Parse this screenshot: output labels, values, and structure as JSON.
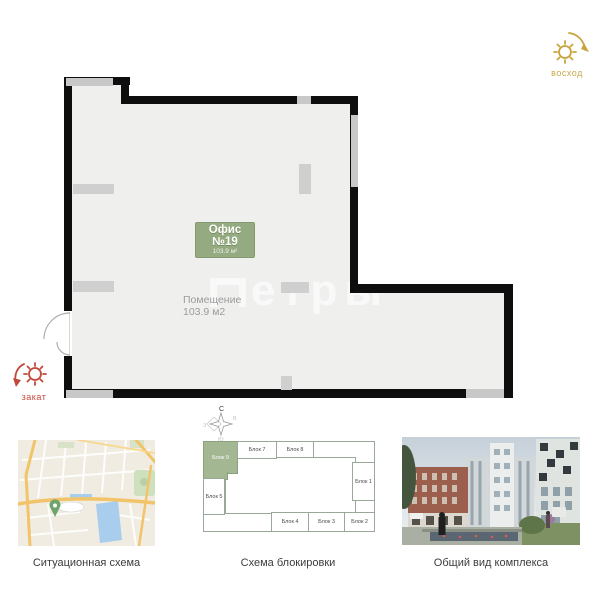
{
  "plan": {
    "badge": {
      "title": "Офис №19",
      "area": "103.9 м²"
    },
    "room": {
      "name": "Помещение",
      "area": "103.9 м2"
    },
    "watermark": "етры"
  },
  "orientation": {
    "sunrise_label": "восход",
    "sunset_label": "закат"
  },
  "compass": {
    "north": "С",
    "east": "В",
    "west": "З",
    "south": "Ю"
  },
  "block_scheme": {
    "blocks": {
      "b9": "Блок 9",
      "b7": "Блок 7",
      "b8": "Блок 8",
      "b1": "Блок 1",
      "b5": "Блок 5",
      "b4": "Блок 4",
      "b3": "Блок 3",
      "b2": "Блок 2"
    },
    "highlighted_block": "Блок 9"
  },
  "captions": {
    "map": "Ситуационная схема",
    "scheme": "Схема блокировки",
    "render": "Общий вид комплекса"
  },
  "colors": {
    "wall": "#0e0e0e",
    "plan_fill": "#eff0ee",
    "window_gray": "#c8c8c8",
    "badge_green": "#94aa81",
    "block_green": "#a3b792",
    "sunrise_gold": "#c8a43c",
    "sunset_red": "#c1493d",
    "pond_blue": "#a9cdec",
    "road_orange": "#f2c46a"
  }
}
